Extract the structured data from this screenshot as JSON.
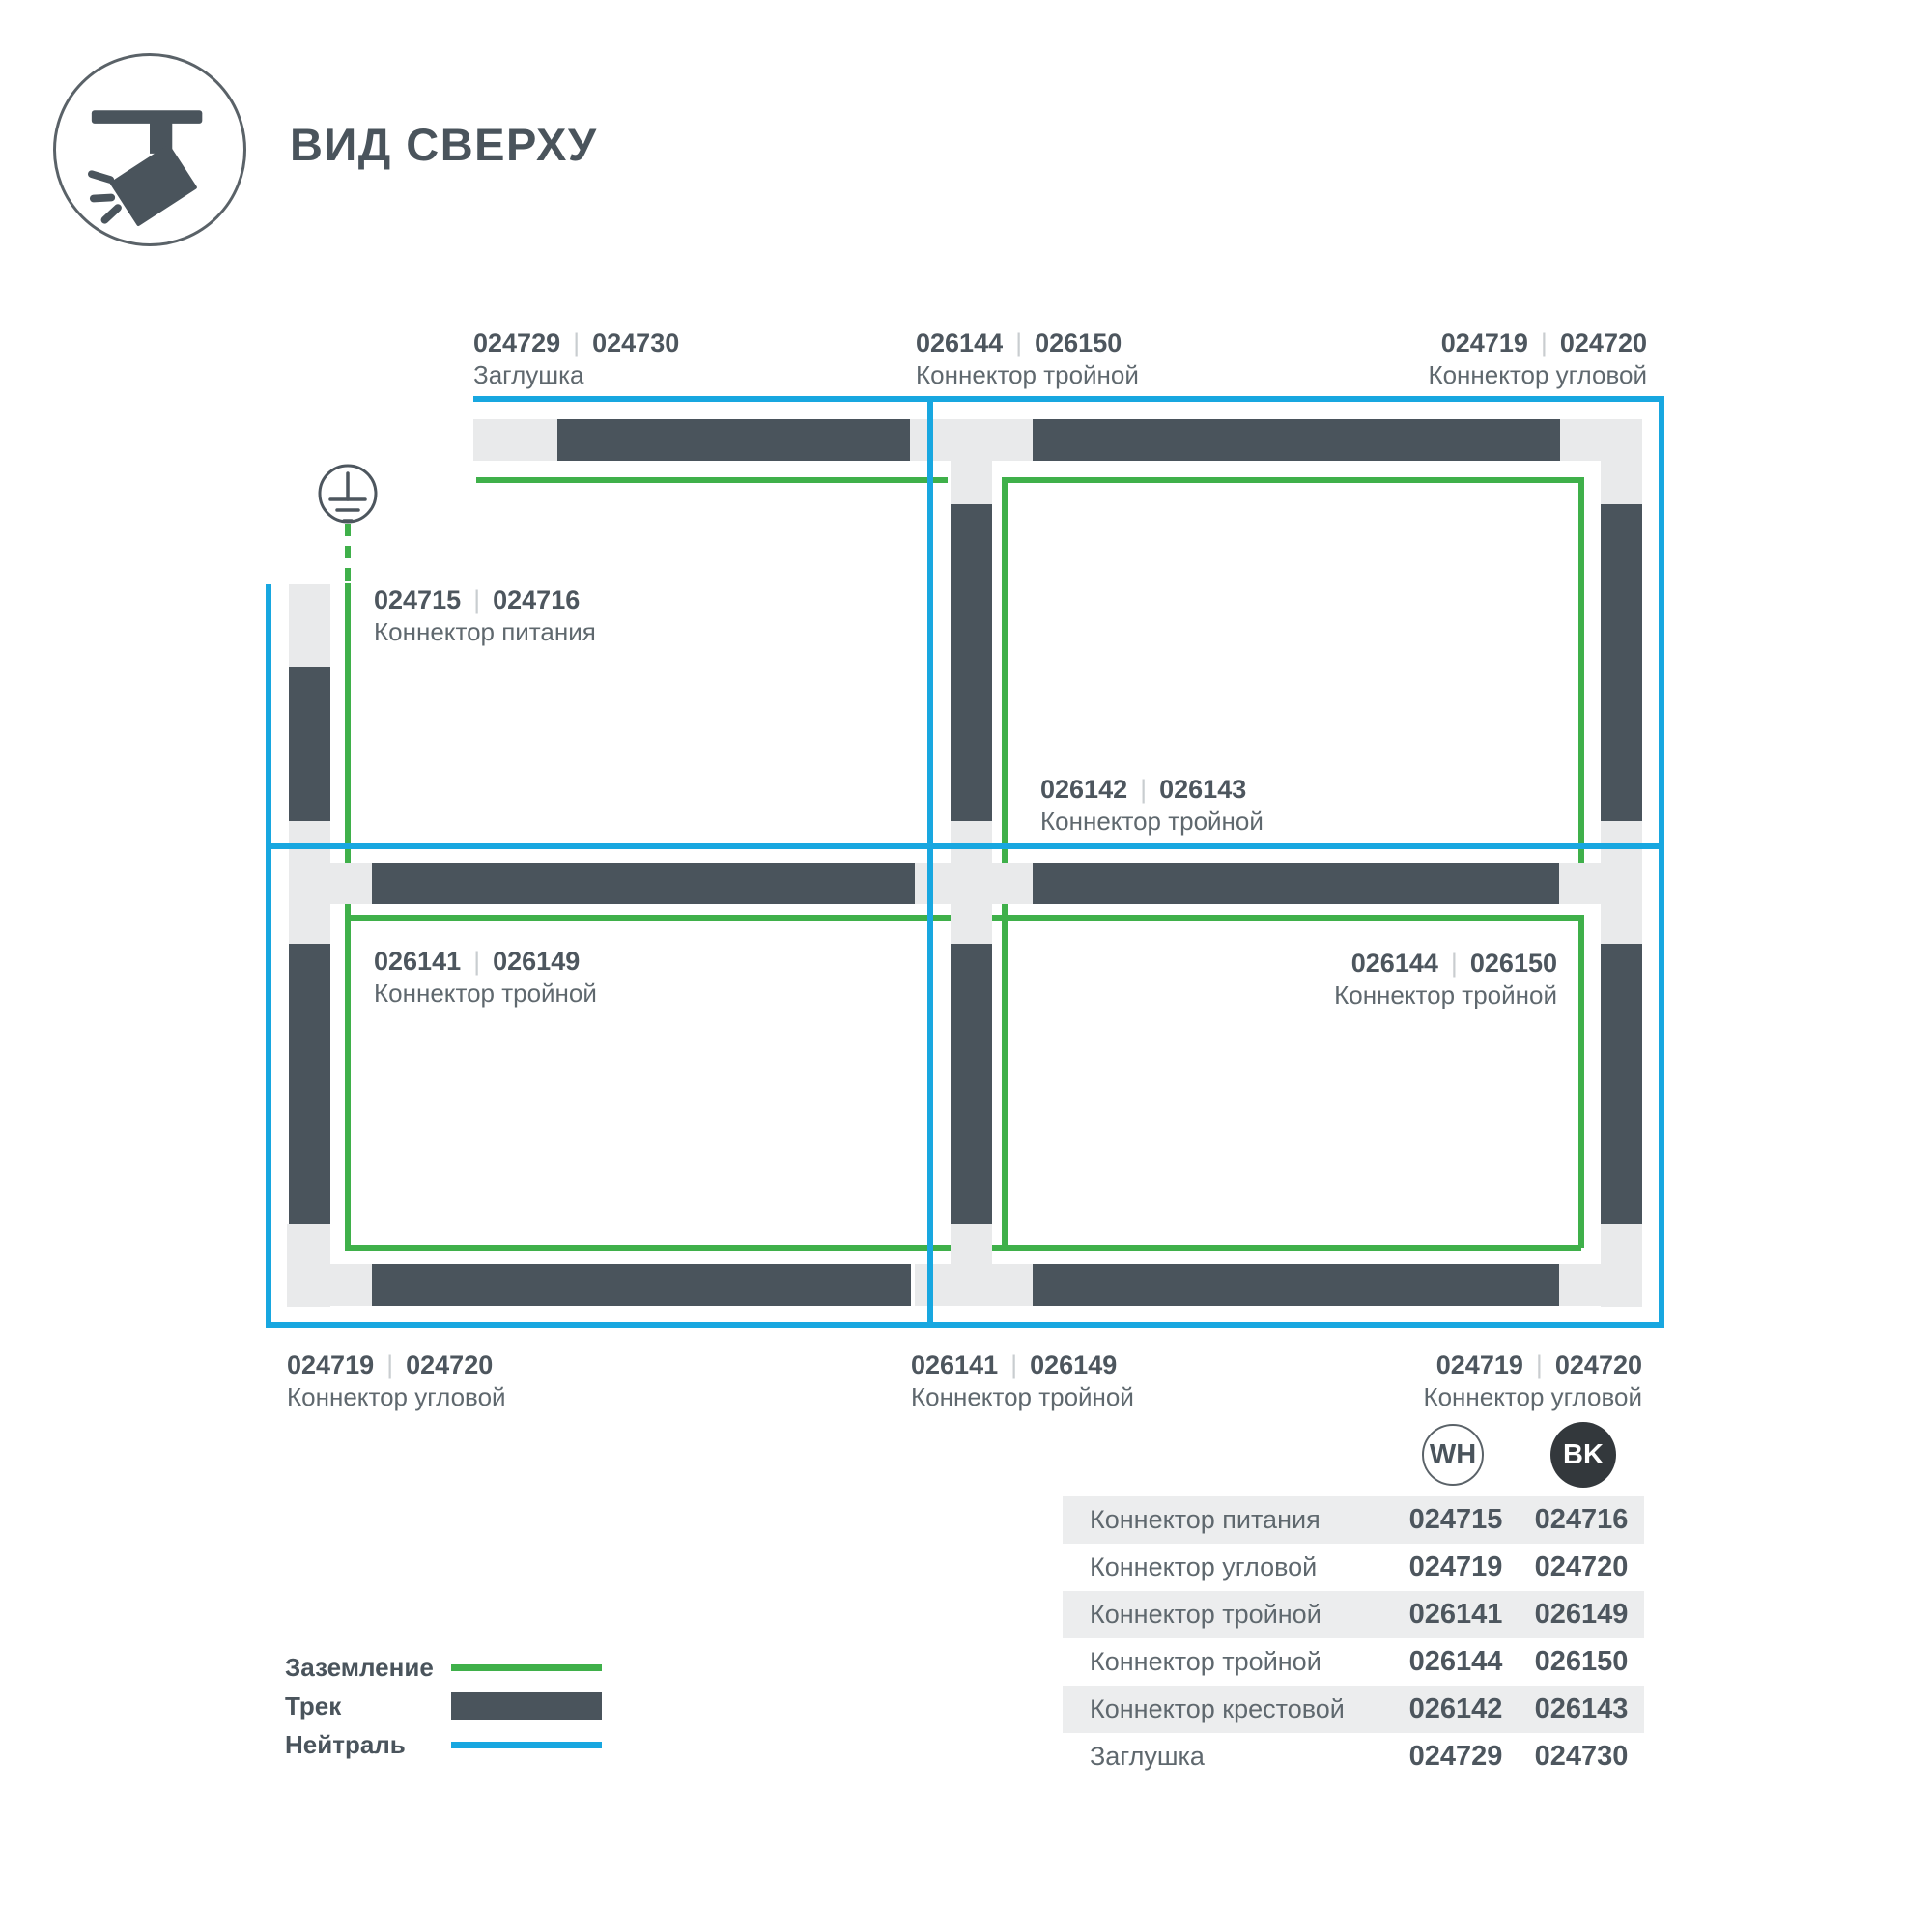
{
  "header": {
    "title": "ВИД СВЕРХУ"
  },
  "diagram": {
    "separator": "|",
    "labels": [
      {
        "code_wh": "024729",
        "code_bk": "024730",
        "name": "Заглушка"
      },
      {
        "code_wh": "026144",
        "code_bk": "026150",
        "name": "Коннектор тройной"
      },
      {
        "code_wh": "024719",
        "code_bk": "024720",
        "name": "Коннектор угловой"
      },
      {
        "code_wh": "024715",
        "code_bk": "024716",
        "name": "Коннектор питания"
      },
      {
        "code_wh": "026142",
        "code_bk": "026143",
        "name": "Коннектор тройной"
      },
      {
        "code_wh": "026141",
        "code_bk": "026149",
        "name": "Коннектор тройной"
      },
      {
        "code_wh": "026144",
        "code_bk": "026150",
        "name": "Коннектор тройной"
      },
      {
        "code_wh": "024719",
        "code_bk": "024720",
        "name": "Коннектор угловой"
      },
      {
        "code_wh": "026141",
        "code_bk": "026149",
        "name": "Коннектор тройной"
      },
      {
        "code_wh": "024719",
        "code_bk": "024720",
        "name": "Коннектор угловой"
      }
    ]
  },
  "legend": {
    "items": [
      {
        "label": "Заземление",
        "swatch": "ground-line"
      },
      {
        "label": "Трек",
        "swatch": "track-bar"
      },
      {
        "label": "Нейтраль",
        "swatch": "neutral-line"
      }
    ]
  },
  "table": {
    "col_wh": "WH",
    "col_bk": "BK",
    "rows": [
      {
        "name": "Коннектор питания",
        "wh": "024715",
        "bk": "024716"
      },
      {
        "name": "Коннектор угловой",
        "wh": "024719",
        "bk": "024720"
      },
      {
        "name": "Коннектор тройной",
        "wh": "026141",
        "bk": "026149"
      },
      {
        "name": "Коннектор тройной",
        "wh": "026144",
        "bk": "026150"
      },
      {
        "name": "Коннектор крестовой",
        "wh": "026142",
        "bk": "026143"
      },
      {
        "name": "Заглушка",
        "wh": "024729",
        "bk": "024730"
      }
    ]
  },
  "colors": {
    "ground": "#3fb04a",
    "neutral": "#18a7e0",
    "track": "#4a545c",
    "connector": "#e9eaeb",
    "text_bold": "#4d565e",
    "text_regular": "#5f686e",
    "table_row_bg": "#ecedee",
    "badge_bk_bg": "#33383c"
  }
}
